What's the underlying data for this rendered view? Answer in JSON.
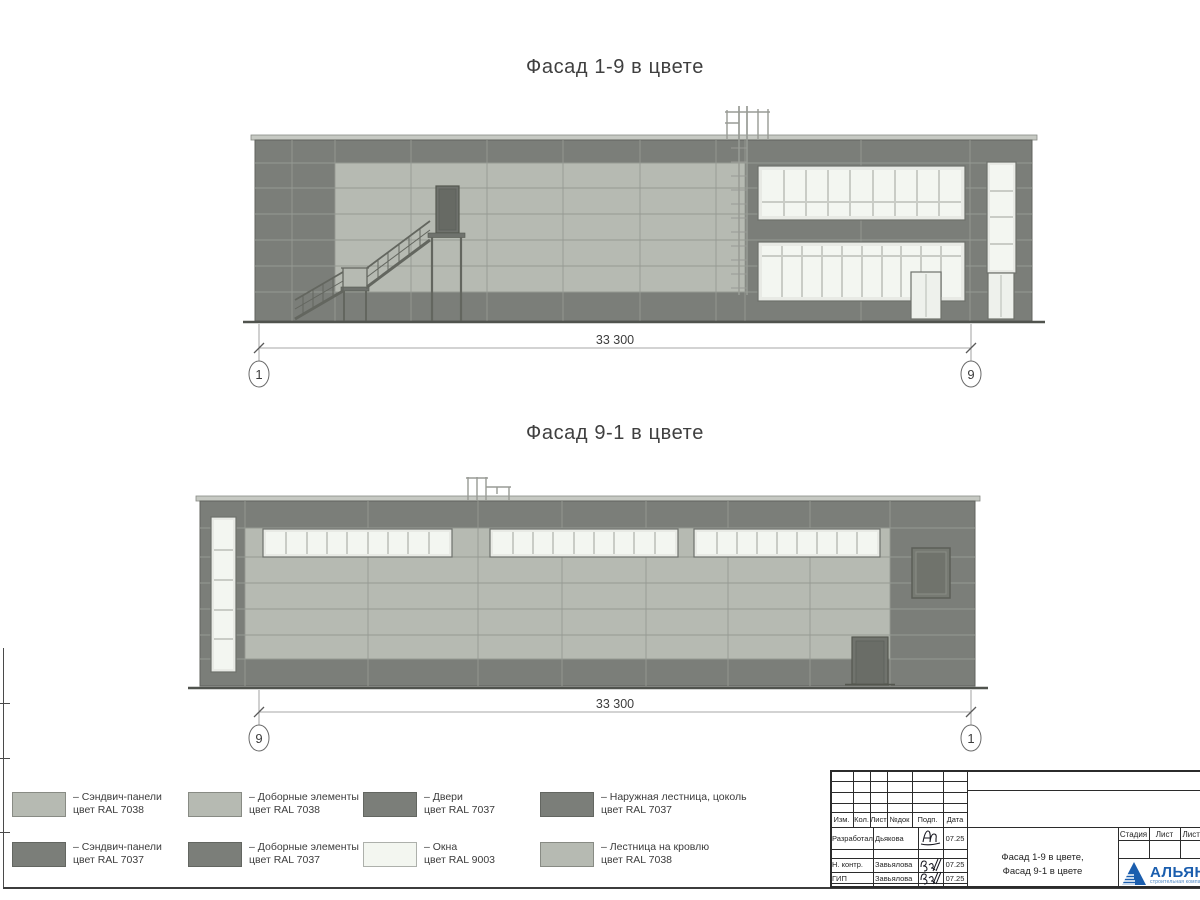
{
  "facade1": {
    "title": "Фасад 1-9 в цвете",
    "dimension": "33 300",
    "marker_left": "1",
    "marker_right": "9"
  },
  "facade2": {
    "title": "Фасад 9-1 в цвете",
    "dimension": "33 300",
    "marker_left": "9",
    "marker_right": "1"
  },
  "legend": {
    "items": [
      {
        "line1": "– Сэндвич-панели",
        "line2": "цвет RAL 7038",
        "color": "#b6bab2"
      },
      {
        "line1": "– Доборные элементы",
        "line2": "цвет RAL 7038",
        "color": "#b6bab2"
      },
      {
        "line1": "– Двери",
        "line2": "цвет RAL 7037",
        "color": "#7b7e79"
      },
      {
        "line1": "– Наружная лестница, цоколь",
        "line2": "цвет RAL 7037",
        "color": "#7b7e79"
      },
      {
        "line1": "– Сэндвич-панели",
        "line2": "цвет RAL 7037",
        "color": "#7b7e79"
      },
      {
        "line1": "– Доборные элементы",
        "line2": "цвет RAL 7037",
        "color": "#7b7e79"
      },
      {
        "line1": "– Окна",
        "line2": "цвет RAL 9003",
        "color": "#f3f6f0"
      },
      {
        "line1": "– Лестница на кровлю",
        "line2": "цвет RAL 7038",
        "color": "#b6bab2"
      }
    ]
  },
  "titleblock": {
    "header_cells": [
      "Изм.",
      "Кол.",
      "Лист",
      "№док",
      "Подп.",
      "Дата"
    ],
    "rows": [
      {
        "role": "Разработал",
        "name": "Дьякова",
        "date": "07.25"
      },
      {
        "role": "Н. контр.",
        "name": "Завьялова",
        "date": "07.25"
      },
      {
        "role": "ГИП",
        "name": "Завьялова",
        "date": "07.25"
      }
    ],
    "doc_title_line1": "Фасад 1-9 в цвете,",
    "doc_title_line2": "Фасад 9-1 в цвете",
    "stage_label": "Стадия",
    "sheet_label": "Лист",
    "sheets_label": "Листов",
    "logo_name": "АЛЬЯНС",
    "logo_sub": "строительная компания"
  },
  "palette": {
    "panel_light_ral7038": "#b6bab2",
    "panel_dark_ral7037": "#7b7e79",
    "window_ral9003": "#f3f6f0",
    "window_frame": "#e8eae5",
    "joint_line": "#969a93",
    "outline": "#60635e",
    "ground": "#50534e",
    "dim_line": "#8a8a8a",
    "text": "#3c3c3c",
    "logo_blue": "#1b5eae"
  }
}
